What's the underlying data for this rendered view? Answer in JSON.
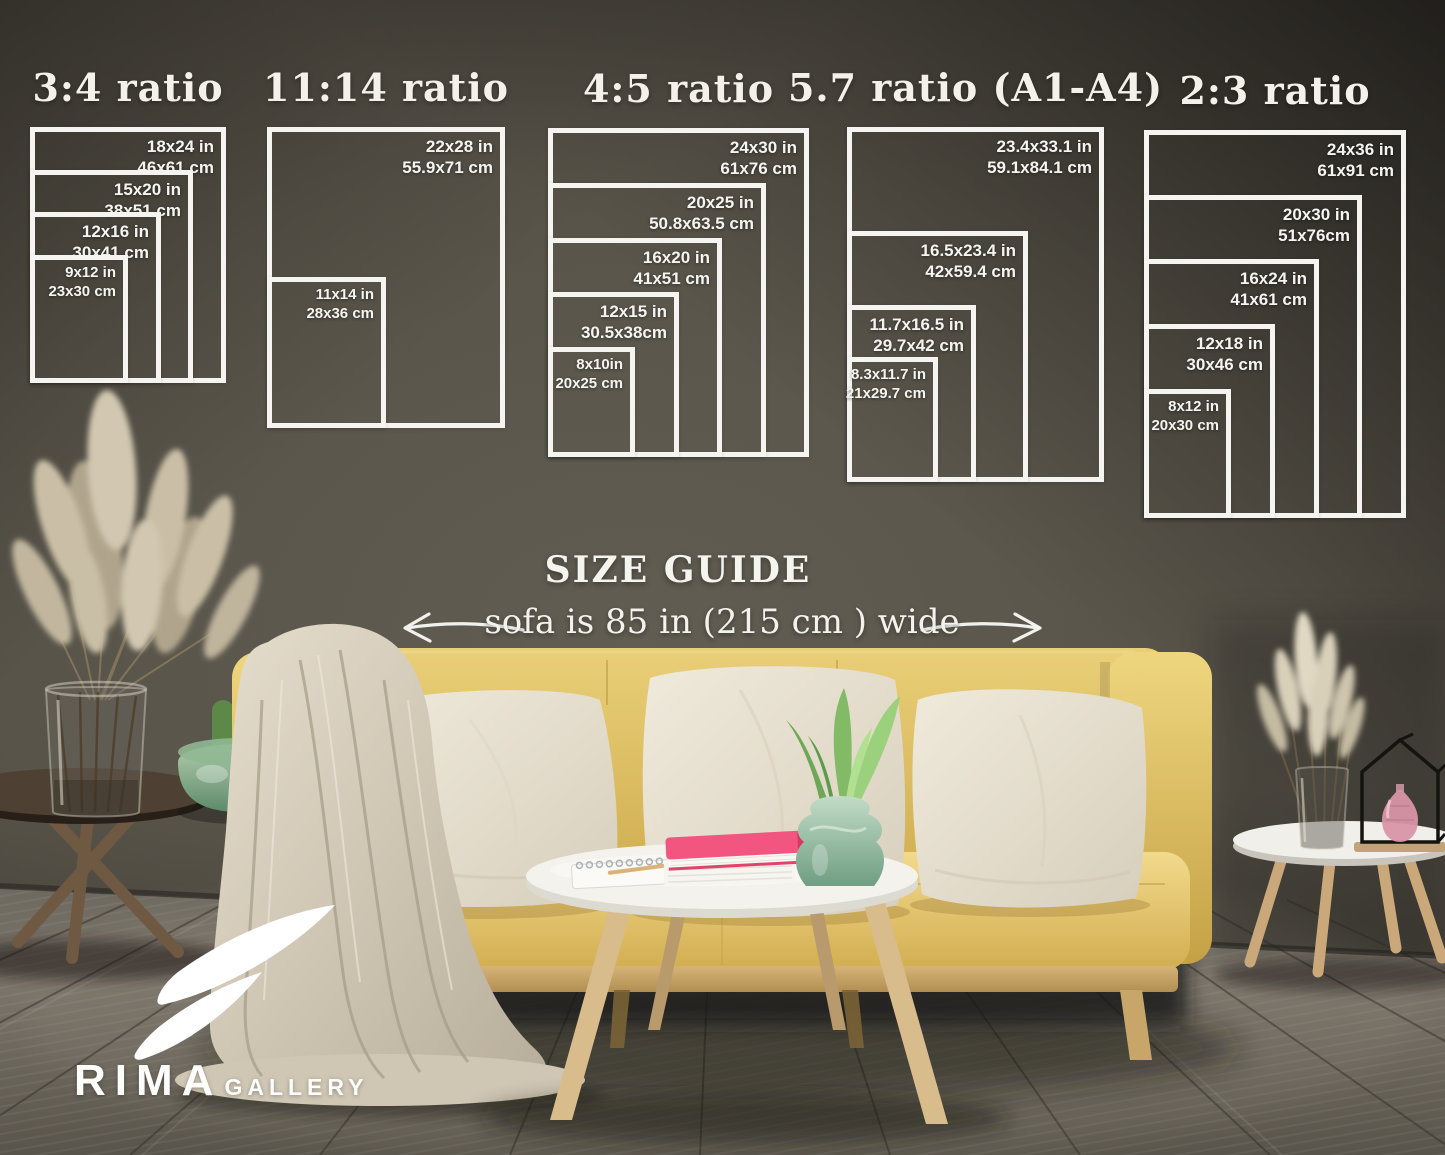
{
  "headings": {
    "size_guide": "SIZE GUIDE",
    "sofa_note": "sofa is 85 in (215 cm ) wide"
  },
  "brand": {
    "name": "RIMA",
    "suffix": "GALLERY"
  },
  "colors": {
    "text": "#f5f4f0",
    "frame_line": "#f5f4f0",
    "wall_center": "#5c584e",
    "wall_edge": "#2a2823",
    "sofa_yellow": "#e2c565",
    "pillow": "#eae4d6",
    "floor": "#6e6960",
    "book_pink": "#f2557f",
    "vase_green": "#8fb89b"
  },
  "ratio_groups": [
    {
      "title": "3:4 ratio",
      "box": {
        "left": 30,
        "top": 127,
        "width": 196,
        "height": 256
      },
      "sizes": [
        {
          "inches": "18x24 in",
          "cm": "46x61 cm",
          "w": 18,
          "h": 24
        },
        {
          "inches": "15x20 in",
          "cm": "38x51 cm",
          "w": 15,
          "h": 20
        },
        {
          "inches": "12x16 in",
          "cm": "30x41 cm",
          "w": 12,
          "h": 16
        },
        {
          "inches": "9x12 in",
          "cm": "23x30 cm",
          "w": 9,
          "h": 12
        }
      ]
    },
    {
      "title": "11:14 ratio",
      "box": {
        "left": 267,
        "top": 127,
        "width": 238,
        "height": 301
      },
      "sizes": [
        {
          "inches": "22x28 in",
          "cm": "55.9x71 cm",
          "w": 22,
          "h": 28
        },
        {
          "inches": "11x14 in",
          "cm": "28x36 cm",
          "w": 11,
          "h": 14
        }
      ]
    },
    {
      "title": "4:5 ratio",
      "box": {
        "left": 548,
        "top": 128,
        "width": 261,
        "height": 329
      },
      "sizes": [
        {
          "inches": "24x30 in",
          "cm": "61x76 cm",
          "w": 24,
          "h": 30
        },
        {
          "inches": "20x25 in",
          "cm": "50.8x63.5 cm",
          "w": 20,
          "h": 25
        },
        {
          "inches": "16x20 in",
          "cm": "41x51 cm",
          "w": 16,
          "h": 20
        },
        {
          "inches": "12x15 in",
          "cm": "30.5x38cm",
          "w": 12,
          "h": 15
        },
        {
          "inches": "8x10in",
          "cm": "20x25 cm",
          "w": 8,
          "h": 10
        }
      ]
    },
    {
      "title": "5.7 ratio (A1-A4)",
      "box": {
        "left": 847,
        "top": 127,
        "width": 257,
        "height": 355
      },
      "sizes": [
        {
          "inches": "23.4x33.1 in",
          "cm": "59.1x84.1 cm",
          "w": 23.4,
          "h": 33.1
        },
        {
          "inches": "16.5x23.4 in",
          "cm": "42x59.4 cm",
          "w": 16.5,
          "h": 23.4
        },
        {
          "inches": "11.7x16.5 in",
          "cm": "29.7x42 cm",
          "w": 11.7,
          "h": 16.5
        },
        {
          "inches": "8.3x11.7 in",
          "cm": "21x29.7 cm",
          "w": 8.3,
          "h": 11.7
        }
      ]
    },
    {
      "title": "2:3 ratio",
      "box": {
        "left": 1144,
        "top": 130,
        "width": 262,
        "height": 388
      },
      "sizes": [
        {
          "inches": "24x36 in",
          "cm": "61x91 cm",
          "w": 24,
          "h": 36
        },
        {
          "inches": "20x30 in",
          "cm": "51x76cm",
          "w": 20,
          "h": 30
        },
        {
          "inches": "16x24 in",
          "cm": "41x61 cm",
          "w": 16,
          "h": 24
        },
        {
          "inches": "12x18 in",
          "cm": "30x46 cm",
          "w": 12,
          "h": 18
        },
        {
          "inches": "8x12 in",
          "cm": "20x30 cm",
          "w": 8,
          "h": 12
        }
      ]
    }
  ]
}
